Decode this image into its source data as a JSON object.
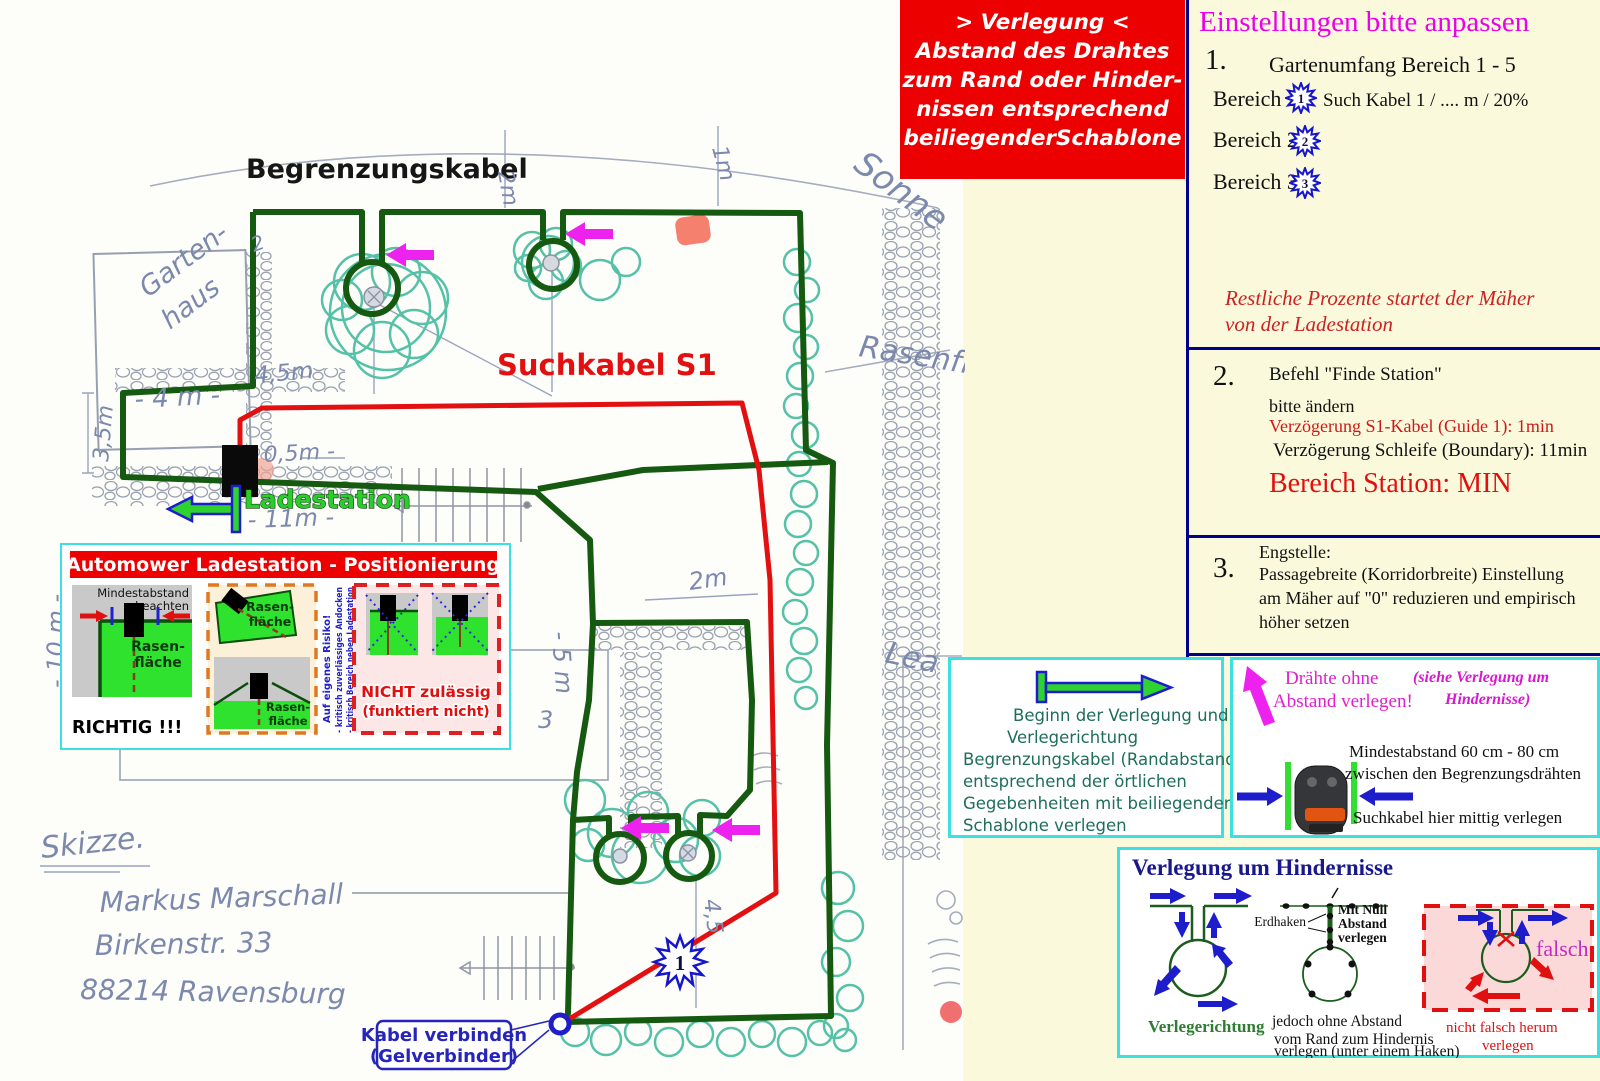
{
  "red_note": {
    "l1": "> Verlegung <",
    "l2": "Abstand des Drahtes",
    "l3": "zum Rand oder Hinder-",
    "l4": "nissen entsprechend",
    "l5": "beiliegenderSchablone"
  },
  "settings": {
    "title": "Einstellungen bitte anpassen",
    "s1_num": "1.",
    "s1_heading": "Gartenumfang Bereich 1 - 5",
    "b1_label": "Bereich 1",
    "b1_star": "1",
    "b1_suffix": "Such Kabel 1 / .... m / 20%",
    "b2_label": "Bereich 2",
    "b2_star": "2",
    "b3_label": "Bereich 3",
    "b3_star": "3",
    "note1": "Restliche Prozente  startet der Mäher",
    "note2": "von der Ladestation",
    "s2_num": "2.",
    "s2_heading": "Befehl \"Finde Station\"",
    "s2_sub": "bitte ändern",
    "s2_red": "Verzögerung S1-Kabel (Guide 1): 1min",
    "s2_black": "Verzögerung Schleife (Boundary): 11min",
    "s2_big": "Bereich Station: MIN",
    "s3_num": "3.",
    "s3_l1": "Engstelle:",
    "s3_l2": "Passagebreite (Korridorbreite) Einstellung",
    "s3_l3": "am Mäher auf \"0\" reduzieren und empirisch",
    "s3_l4": "höher setzen"
  },
  "sketch": {
    "begrenzungskabel": "Begrenzungskabel",
    "suchkabel": "Suchkabel S1",
    "ladest": "Ladestation",
    "star1": "1",
    "kabel1": "Kabel verbinden",
    "kabel2": "(Gelverbinder)",
    "hw": {
      "gartenhaus1": "Garten-",
      "gartenhaus2": "haus",
      "sonne": "Sonne",
      "rasen": "Rasenfl",
      "terrasse": "Terrasse",
      "lea": "Lea",
      "skizze": "Skizze.",
      "name": "Markus Marschall",
      "street": "Birkenstr. 33",
      "city": "88214 Ravensburg",
      "d2m_top": "2m",
      "d1m": "1m",
      "d45": "4,5m",
      "d4": "- 4 m -",
      "d35": "3,5m",
      "d05": "0,5m -",
      "d11": "- 11m -",
      "d5h": "- 5 m",
      "d5v": "- 5 m",
      "d5v2": "3",
      "d10": "- 10 m -",
      "d2m": "2m",
      "d45v": "4,5",
      "mark2": "2"
    }
  },
  "posbox": {
    "title": "Automower Ladestation - Positionierung",
    "p1_note1": "Mindestabstand",
    "p1_note2": "beachten",
    "p1_lawn1": "Rasen-",
    "p1_lawn2": "fläche",
    "p1_verdict": "RICHTIG !!!",
    "p2_lawn1a": "Rasen-",
    "p2_lawn1b": "fläche",
    "p2_lawn2a": "Rasen-",
    "p2_lawn2b": "fläche",
    "p2_warn1": "Auf eigenes Risiko!",
    "p2_warn2": "- kritisch zuverlässiges Andocken",
    "p2_warn3": "- kritisch Bereich neben Ladestation",
    "p3_verdict1": "NICHT zulässig",
    "p3_verdict2": "(funktiert nicht)"
  },
  "beginbox": {
    "l1": "Beginn der Verlegung und",
    "l2": "Verlegerichtung",
    "l3": "Begrenzungskabel (Randabstand)",
    "l4": "entsprechend der örtlichen",
    "l5": "Gegebenheiten mit beiliegender",
    "l6": "Schablone verlegen"
  },
  "wirebox": {
    "m1": "Drähte ohne",
    "m2": "Abstand verlegen!",
    "a1": "(siehe Verlegung um",
    "a2": "Hindernisse)",
    "b1": "Mindestabstand 60 cm - 80 cm",
    "b2": "zwischen den Begrenzungsdrähten",
    "b3": "Suchkabel hier mittig verlegen"
  },
  "obsbox": {
    "title": "Verlegung um Hindernisse",
    "verlegerichtung": "Verlegerichtung",
    "erdhaken": "Erdhaken",
    "mn1": "Mit Null",
    "mn2": "Abstand",
    "mn3": "verlegen",
    "j1": "jedoch ohne Abstand",
    "j2": "vom Rand zum Hindernis",
    "j3": "verlegen (unter einem Haken)",
    "falsch": "falsch",
    "n1": "nicht falsch herum",
    "n2": "verlegen"
  },
  "colors": {
    "cable_green": "#155a10",
    "cable_red": "#e21010",
    "accent_magenta": "#ee22ee",
    "panel_yellow": "#fbf9dc",
    "note_red": "#ec0000",
    "border_blue": "#00008c",
    "box_cyan": "#3ce0e0"
  }
}
